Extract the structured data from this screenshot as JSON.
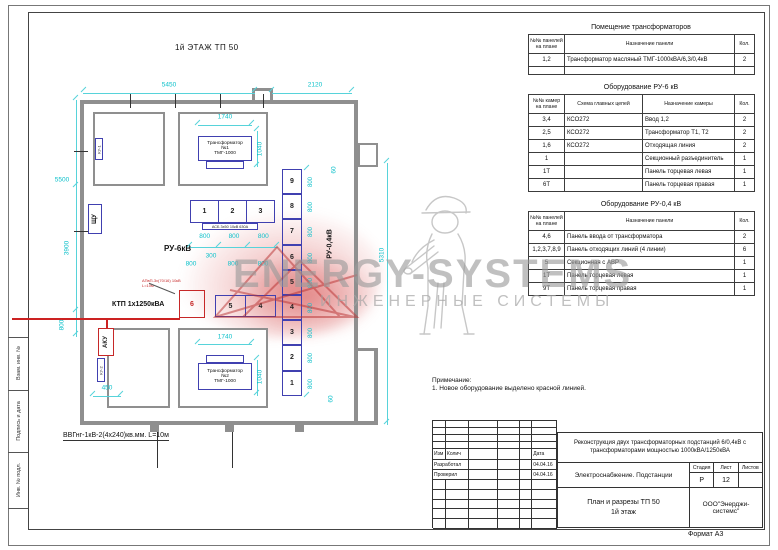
{
  "frame": {
    "side_labels": [
      "Взам. инв. №",
      "Подпись и дата",
      "Инв. № подл."
    ],
    "format_label": "Формат А3"
  },
  "plan": {
    "title": "1й ЭТАЖ ТП 50",
    "dims": {
      "top_left": "5450",
      "top_right": "2120",
      "t1_w": "1740",
      "t1_h": "1040",
      "t2_w": "1740",
      "t2_h": "1040",
      "left_total": "5500",
      "left_mid": "3900",
      "left_low": "800",
      "aku_w": "450",
      "gap": "300",
      "mid_a": "800",
      "mid_b": "800",
      "mid_c": "800",
      "right_top": "60",
      "right_bottom": "60",
      "right_total": "5310"
    },
    "ru6_top_dims": [
      "800",
      "800",
      "800"
    ],
    "rooms": {
      "t1_lines": "Трансформатор\n№1\nТМГ-1000",
      "t2_lines": "Трансформатор\n№2\nТМГ-1000"
    },
    "labels": {
      "ru6": "РУ-6кВ",
      "ru04": "РУ-0,4кВ",
      "ktp": "КТП 1х1250кВА",
      "schu": "ЩУ",
      "aku": "АКУ",
      "ku1": "КУ-1",
      "ku2": "КУ-2"
    },
    "cables": {
      "bottom": "ВВГнг-1кВ-2(4х240)кв.мм.  L=10м",
      "asb": "АСБ 3х50 10кВ 630А",
      "red_note": "АПвП-3х(70/16) 10кВ\nL=10м"
    },
    "ru6_row1": [
      "1",
      "2",
      "3"
    ],
    "ru6_row2": [
      "5",
      "4"
    ],
    "ktp_cell_label": "6",
    "ru04_cells": [
      {
        "label": "9",
        "dim": "800"
      },
      {
        "label": "8",
        "dim": "800"
      },
      {
        "label": "7",
        "dim": "800"
      },
      {
        "label": "6",
        "dim": "800"
      },
      {
        "label": "5",
        "dim": "800"
      },
      {
        "label": "4",
        "dim": "800"
      },
      {
        "label": "3",
        "dim": "800"
      },
      {
        "label": "2",
        "dim": "800"
      },
      {
        "label": "1",
        "dim": "800"
      }
    ]
  },
  "tables": [
    {
      "title": "Помещение трансформаторов",
      "widths": [
        36,
        170,
        20
      ],
      "columns": [
        "№№ панелей\nна плане",
        "Назначение панели",
        "Кол."
      ],
      "rows": [
        [
          "1,2",
          "Трансформатор масляный ТМГ-1000кВА/6,3/0,4кВ",
          "2"
        ],
        [
          "",
          "",
          ""
        ]
      ]
    },
    {
      "title": "Оборудование РУ-6 кВ",
      "widths": [
        36,
        78,
        92,
        20
      ],
      "columns": [
        "№№ камер\nна плане",
        "Схема главных цепей",
        "Назначение камеры",
        "Кол."
      ],
      "rows": [
        [
          "3,4",
          "КСО272",
          "Ввод 1,2",
          "2"
        ],
        [
          "2,5",
          "КСО272",
          "Трансформатор Т1, Т2",
          "2"
        ],
        [
          "1,6",
          "КСО272",
          "Отходящая линия",
          "2"
        ],
        [
          "1",
          "",
          "Секционный разъединитель",
          "1"
        ],
        [
          "1Т",
          "",
          "Панель торцевая левая",
          "1"
        ],
        [
          "6Т",
          "",
          "Панель торцевая правая",
          "1"
        ]
      ]
    },
    {
      "title": "Оборудование РУ-0,4 кВ",
      "widths": [
        36,
        170,
        20
      ],
      "columns": [
        "№№ панелей\nна плане",
        "Назначение панели",
        "Кол."
      ],
      "rows": [
        [
          "4,6",
          "Панель ввода от трансформатора",
          "2"
        ],
        [
          "1,2,3,7,8,9",
          "Панель отходящих линий (4 линии)",
          "6"
        ],
        [
          "5",
          "Секционная с АВР",
          "1"
        ],
        [
          "1Т",
          "Панель торцевая левая",
          "1"
        ],
        [
          "9Т",
          "Панель торцевая правая",
          "1"
        ]
      ]
    }
  ],
  "note": {
    "title": "Примечание:",
    "line": "1. Новое оборудование выделено красной линией."
  },
  "stamp": {
    "header": [
      "Изм",
      "Колич",
      "",
      "",
      "",
      "Дата"
    ],
    "rows": [
      {
        "label": "Разработал",
        "date": "04.04.16"
      },
      {
        "label": "Проверил",
        "date": "04.04.16"
      }
    ],
    "project": "Реконструкция двух трансформаторных подстанций 6/0,4кВ с трансформаторами мощностью 1000кВА/1250кВА",
    "object": "Электроснабжение. Подстанции",
    "stage_header": [
      "Стадия",
      "Лист",
      "Листов"
    ],
    "stage_values": [
      "Р",
      "12",
      ""
    ],
    "drawing_title": "План и разрезы ТП 50\n1й этаж",
    "company": "ООО\"Энерджи-системс\""
  },
  "watermark": {
    "brand": "ENERGY-SYSTEMS",
    "tagline": "ИНЖЕНЕРНЫЕ СИСТЕМЫ"
  }
}
